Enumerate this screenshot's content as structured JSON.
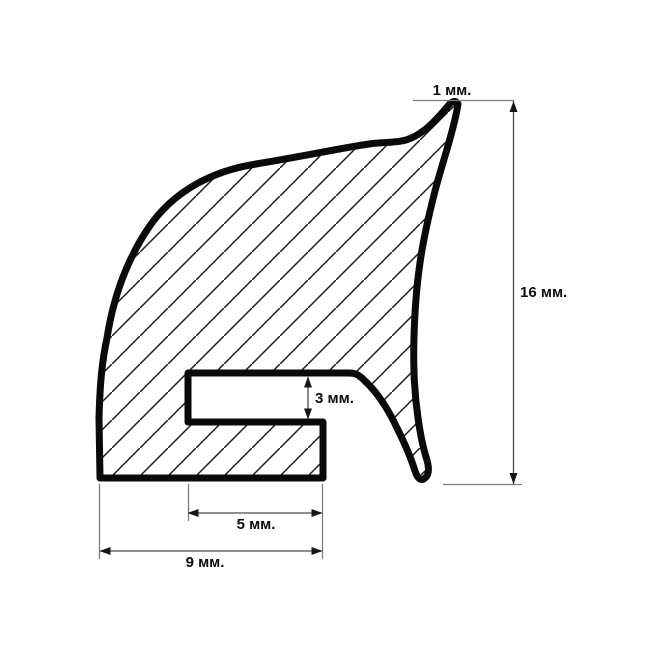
{
  "drawing": {
    "type": "cross-section-profile",
    "unit": "мм",
    "canvas": {
      "width": 650,
      "height": 650,
      "background": "#ffffff"
    },
    "profile": {
      "name": "seal-profile",
      "path": "M 100,478 L 99,418 C 100,382 102,362 107,338 C 113,299 126,261 149,227 C 173,192 211,171 256,164 C 300,157 341,148 369,144 C 383,142 395,143 406,140 C 423,135 437,119 448,106 Q 454,98 458,104 C 456,118 449,143 442,166 C 433,196 423,238 419,270 C 415,300 413,340 414,372 C 415,404 420,437 426,457 C 429,466 430,474 425,478 Q 419,483 415,471 C 411,458 404,442 397,428 C 389,411 378,393 365,381 C 359,375 356,373 349,373 L 188,373 L 188,422 L 323,422 L 323,478 Z",
      "outline_color": "#0a0a0a",
      "outline_width": 7,
      "hatch_tile": 28,
      "hatch_width": 1.5,
      "hatch_color": "#1c1c1c"
    },
    "dimension_styles": {
      "dim_line_color": "#4a4a4a",
      "ext_line_color": "#7d7d7d",
      "line_width": 1.3,
      "arrow_color": "#161616",
      "arrow_length": 11,
      "arrow_half_width": 4,
      "label_color": "#0e0e0e",
      "label_font_size": 15
    },
    "dimensions": [
      {
        "id": "tip-thickness",
        "label": "1 мм.",
        "value": 1,
        "label_pos": [
          452,
          95
        ],
        "label_anchor": "middle",
        "lines": [
          {
            "x1": 413,
            "y1": 100.5,
            "x2": 514,
            "y2": 100.5,
            "kind": "ext"
          }
        ],
        "arrows": []
      },
      {
        "id": "overall-height",
        "label": "16 мм.",
        "value": 16,
        "label_pos": [
          520,
          297
        ],
        "label_anchor": "start",
        "lines": [
          {
            "x1": 513.5,
            "y1": 101,
            "x2": 513.5,
            "y2": 484,
            "kind": "dim"
          },
          {
            "x1": 443,
            "y1": 484.5,
            "x2": 522,
            "y2": 484.5,
            "kind": "ext"
          }
        ],
        "arrows": [
          {
            "x": 513.5,
            "y": 101,
            "dir": "up"
          },
          {
            "x": 513.5,
            "y": 484,
            "dir": "down"
          }
        ]
      },
      {
        "id": "slot-height",
        "label": "3 мм.",
        "value": 3,
        "label_pos": [
          315,
          403
        ],
        "label_anchor": "start",
        "lines": [
          {
            "x1": 308,
            "y1": 377,
            "x2": 308,
            "y2": 419,
            "kind": "dim"
          }
        ],
        "arrows": [
          {
            "x": 308,
            "y": 376.5,
            "dir": "up"
          },
          {
            "x": 308,
            "y": 419.5,
            "dir": "down"
          }
        ]
      },
      {
        "id": "slot-depth",
        "label": "5 мм.",
        "value": 5,
        "label_pos": [
          256,
          529
        ],
        "label_anchor": "middle",
        "lines": [
          {
            "x1": 188,
            "y1": 513,
            "x2": 322,
            "y2": 513,
            "kind": "dim"
          },
          {
            "x1": 188.5,
            "y1": 484,
            "x2": 188.5,
            "y2": 521,
            "kind": "ext"
          }
        ],
        "arrows": [
          {
            "x": 187.5,
            "y": 513,
            "dir": "left"
          },
          {
            "x": 322.5,
            "y": 513,
            "dir": "right"
          }
        ]
      },
      {
        "id": "base-width",
        "label": "9 мм.",
        "value": 9,
        "label_pos": [
          205,
          567
        ],
        "label_anchor": "middle",
        "lines": [
          {
            "x1": 100,
            "y1": 551,
            "x2": 322,
            "y2": 551,
            "kind": "dim"
          },
          {
            "x1": 99.5,
            "y1": 484,
            "x2": 99.5,
            "y2": 559,
            "kind": "ext"
          },
          {
            "x1": 322.5,
            "y1": 484,
            "x2": 322.5,
            "y2": 559,
            "kind": "ext"
          }
        ],
        "arrows": [
          {
            "x": 99.5,
            "y": 551,
            "dir": "left"
          },
          {
            "x": 322.5,
            "y": 551,
            "dir": "right"
          }
        ]
      }
    ]
  }
}
